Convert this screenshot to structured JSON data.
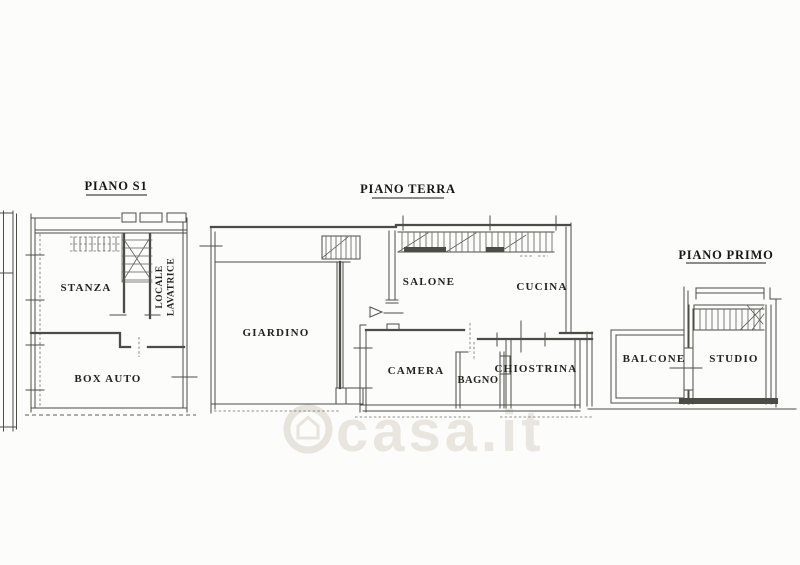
{
  "document": {
    "type": "scanned floor plan",
    "colors": {
      "background": "#fcfcfb",
      "line": "#4c4c47",
      "text": "#1a1a16",
      "watermark": "#e8e5de"
    }
  },
  "plans": {
    "piano_s1": {
      "title": "PIANO S1",
      "rooms": {
        "stanza": "STANZA",
        "locale_lavatrice": [
          "LOCALE",
          "LAVATRICE"
        ],
        "box_auto": "BOX AUTO"
      }
    },
    "piano_terra": {
      "title": "PIANO TERRA",
      "rooms": {
        "giardino": "GIARDINO",
        "salone": "SALONE",
        "cucina": "CUCINA",
        "camera": "CAMERA",
        "bagno": "BAGNO",
        "chiostrina": "CHIOSTRINA"
      }
    },
    "piano_primo": {
      "title": "PIANO PRIMO",
      "rooms": {
        "balcone": "BALCONE",
        "studio": "STUDIO"
      }
    }
  },
  "watermark": {
    "text": "casa.it",
    "icon": "house-in-circle-icon"
  }
}
